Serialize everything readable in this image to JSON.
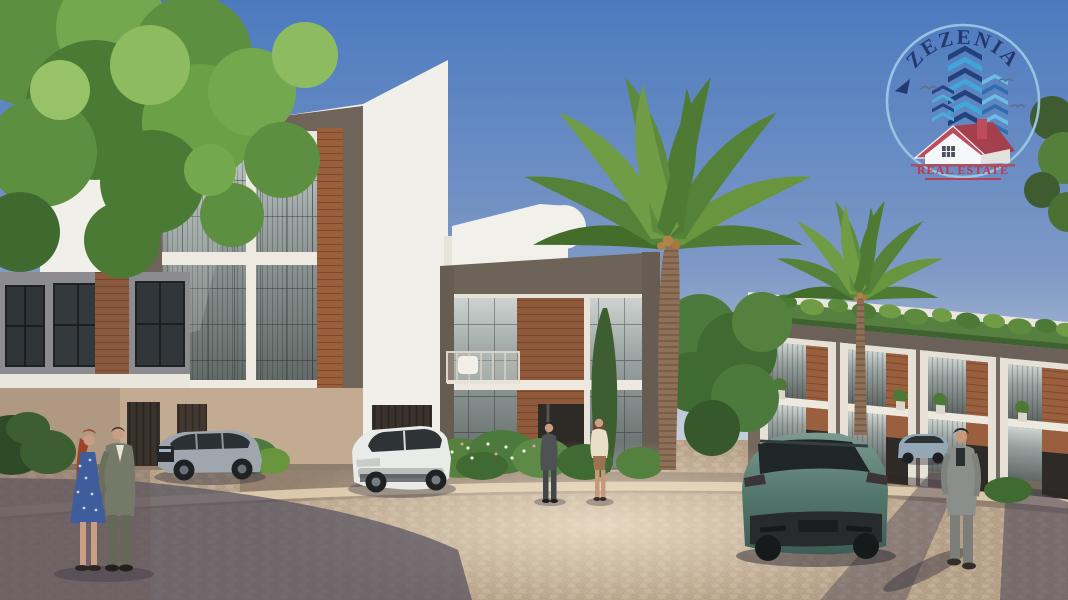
{
  "logo": {
    "brand_name": "ZEZENIA",
    "tagline": "REAL ESTATE",
    "emblem_icons": [
      "chevron-skyscraper-towers-icon",
      "red-roof-house-icon",
      "flying-birds-icon",
      "circle-ring-icon",
      "swallow-arrow-icon"
    ],
    "colors": {
      "brand_text": "#21356b",
      "tagline_text": "#bf3545",
      "ring": "#9bc7e2",
      "tower_dark_blue": "#1f3e7a",
      "tower_light_blue": "#3fa9dc",
      "house_roof": "#c24a55",
      "house_wall": "#fdfdfb"
    }
  },
  "scene": {
    "setting": "daytime street view of a modern residential compound with cobblestone plaza",
    "sky": {
      "top": "#4c7abf",
      "horizon": "#c6cedb"
    },
    "buildings": [
      {
        "name": "left-townhouse-block",
        "floors": 3,
        "style": "white frame, taupe border, glass curtain wall, wood panel strip, beige garage level"
      },
      {
        "name": "center-villa",
        "floors": 2,
        "style": "white volume with curved stair tower, taupe band, wood core, balcony with white chair"
      },
      {
        "name": "right-townhouse-row",
        "floors": 2,
        "style": "glass and wood duplex row with rooftop greenery and potted plants"
      }
    ],
    "vehicles": [
      {
        "name": "silver-suv-left",
        "color": "#9fa6ad"
      },
      {
        "name": "white-suv-center",
        "color": "#e9ebe8"
      },
      {
        "name": "teal-suv-road",
        "color": "#54776d"
      },
      {
        "name": "parked-car-right",
        "color": "#94a7b6"
      }
    ],
    "people": [
      {
        "name": "woman-left",
        "detail": "red hair, blue floral dress"
      },
      {
        "name": "man-left",
        "detail": "olive-gray suit"
      },
      {
        "name": "man-center",
        "detail": "dark suit"
      },
      {
        "name": "woman-center",
        "detail": "cream top, tan skirt"
      },
      {
        "name": "man-right",
        "detail": "gray suit, walking"
      }
    ],
    "vegetation": [
      "leafy-tree-left",
      "tall-palm-center",
      "palm-right",
      "rooftop-greenery",
      "flower-bushes",
      "cypress",
      "hedge-trees",
      "foliage-right-edge"
    ],
    "ground": {
      "pavement": "cobblestone",
      "base_color": "#c9b399",
      "shadow_color": "#55505e",
      "curb_color": "#dbc7aa"
    }
  }
}
